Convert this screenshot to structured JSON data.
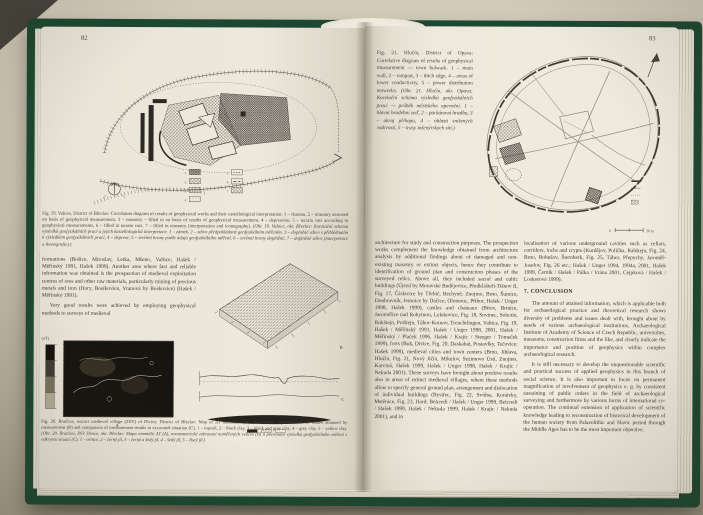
{
  "photo": {
    "background_hex": "#cdc5b3",
    "cover_green_hex": "#1c4730",
    "paper_hex": "#ece8db",
    "ink_hex": "#3d3933"
  },
  "left_page": {
    "page_number": "82",
    "fig19": {
      "caption_en": "Fig. 19. Valtice, District of Břeclav: Correlation diagram of results of geophysical works and their castellological interpretation. 1 – chateau, 2 – masonry assessed on basis of geophysical measurement, 3 – masonry – filled in on basis of results of geophysical measurement, 4 – depression, 5 – terrain cuts according to geophysical measurements, 6 – filled in terrain cuts, 7 – filled in masonry (interpretation and iconography).",
      "caption_cz": "(Obr. 19. Valtice, okr. Břeclav: Korelační schema výsledků geofyzikálních prací a jejich kastellologická interpretace. 1 – zámek, 2 – zdivo předpokládané geofyzikálním měřením, 3 – doplněné zdivo s přihlédnutím k výsledkům geofyzikálních prací, 4 – deprese, 5 – terénní hrany podle údajů geofyzikálního měření, 6 – terénní hrany doplněné, 7 – doplněné zdivo (interpretace a ikonografie).)",
      "legend_numbers": [
        "1",
        "2",
        "3",
        "4",
        "5",
        "6",
        "7"
      ]
    },
    "body_paragraph_1": "formations (Bošice, Miroslav, Letka, Mšeno, Valtice; Hašek / Měřínský 1991, Hašek 1999). Another area where fast and reliable information was obtained is the prospection of medieval exploitation centres of ores and other raw materials, particularly mining of precious metals and iron (Hory, Bosíkovice, Vranová by Boskovice) (Hašek / Měřínský 1991).",
    "body_paragraph_2": "Very good results were achieved by employing geophysical methods to surveys of medieval",
    "fig20": {
      "unit_label": "(nT)",
      "panel_a_label": "A",
      "panel_b_label": "B",
      "panel_c_label": "C",
      "caption_en": "Fig. 20. Bratčice, extinct medieval village (ZSV) of Divice, District of Břeclav: Map of ΔT anomalies (A), axonometric representation of values obtained by measurement (B) and comparison of measurement results to excavated situation (C). 1 – topsoil, 2 – black clay, 3 – black and grey clay, 4 – grey clay, 5 – yellow clay.",
      "caption_cz": "(Obr. 20. Bratčice, ZSV Divice, okr. Břeclav: Mapa anomálií ΔT (A), axonometrické zobrazení naměřených veličin (B) a porovnání výsledků geofyzikálního měření s odkrytou situací (C). 1 – ornice, 2 – černý jíl, 3 – černý a šedý jíl, 4 – šedý jíl, 5 – žlutý jíl.)"
    }
  },
  "right_page": {
    "page_number": "83",
    "fig21": {
      "caption_en_1": "Fig. 21. Hlučín, District of Opava: Correlative diagram of results of geophysical measurement — town bulwark.",
      "caption_en_2": "1 – main wall, 2 – rampart, 3 – ditch edge, 4 – areas of lower conductivity, 5 – power distribution networks.",
      "caption_cz_1": "(Obr. 21. Hlučín, okr. Opava: Korelační schéma výsledků geofyzikálních prací — průběh městského opevnění.",
      "caption_cz_2": "1 – hlavní hradební zeď, 2 – parkánová hradba, 3 – okraj příkopu, 4 – oblasti snížených vodivostí, 5 – trasy inženýrských sítí.)",
      "scale_zero": "0",
      "scale_label": "50 m"
    },
    "column_left": "architecture for study and construction purposes. The prospection works complement the knowledge obtained from architecture analysis by additional findings about of damaged and non-existing masonry or extinct objects, hence they contribute to identification of ground plan and construction phases of the surveyed relics. Above all, they included sacral and cultic buildings (Újezd by Moravské Budějovice, Předklášteří-Tišnov II, Fig. 17, Čáslavice by Třebíč, Bechyně, Znojmo, Brno, Šumice, Doubravník, Jemnice by Dačice, Olomouc, Příbor, Hašek / Unger 1998, Hašek 1999), castles and chateaux (Bítov, Brtnice, Jaroměřice nad Rokytnou, Lelekovice, Fig. 18, Sovinec, Sobotín, Rokštejn, Potštejn, Tábor-Kotnov, Treuchtlingen, Valtice, Fig. 19, Hašek / Měřínský 1991, Hašek / Unger 1998, 2001, Hašek / Měřínský / Plaček 1996, Hašek / Krajíc / Steeger / Tomeček 1999), forts (Buk, Divice, Fig. 20, Daskabát, Postavlky, Tečovice: Hašek 1999), medieval cities and town centers (Brno, Jihlava, Hlučín, Fig. 21, Nový Jičín, Mikulov, Sezimovo Ústí, Znojmo, Karviná, Hašek 1999, Hašek / Unger 1998, Hašek / Krajíc / Nekuda 2001). These surveys have brought about positive results also in areas of extinct medieval villages, where these methods allow to specify general ground plan, arrangement and dislocation of individual buildings (Bystřec, Fig. 22, Svídna, Konůvky, Mstěnice, Fig. 23, Hard; Belcredi / Hašek / Unger 1999, Belcredi / Hašek 1999, Hašek / Nekuda 1999, Hašek / Krajíc / Nekuda 2001), and in",
    "column_right_p1": "localisation of various underground cavities such as cellars, corridors, lochs and crypts (Kurdějov, Polička, Rabštejn, Fig. 24, Brno, Bohušov, Šternberk, Fig. 25, Tábor, Přepychy, Jaroměř-Josefov, Fig. 26 etc.; Hašek / Unger 1994, 1994a, 2001, Hašek 1999, Černík / Hašek / Pálka / Vrána 2001, Cejpková / Hašek / Loskotová 1999).",
    "conclusion_heading": "7. CONCLUSION",
    "conclusion_p1": "The amount of attained information, which is applicable both for archaeological practice and theoretical research shows diversity of problems and issues dealt with, brought about by needs of various archaeological institutions, Archaeological Institute of Academy of Science of Czech Republic, universities, museums, construction firms and the like, and clearly indicate the importance and position of geophysics within complex archaeological research.",
    "conclusion_p2": "It is still necessary to develop the unquestionable scientific and practical success of applied geophysics in this branch of social science. It is also important to focus on permanent magnification of involvement of geophysics e. g. by consistent sustaining of public orders in the field of archaeological surveying and furthermore by various forms of international co-operation. The continual extension of application of scientific knowledge leading to reconstruction of historical development of the human society from Palaeolithic and Slavic period through the Middle Ages has to be the most important objective."
  }
}
